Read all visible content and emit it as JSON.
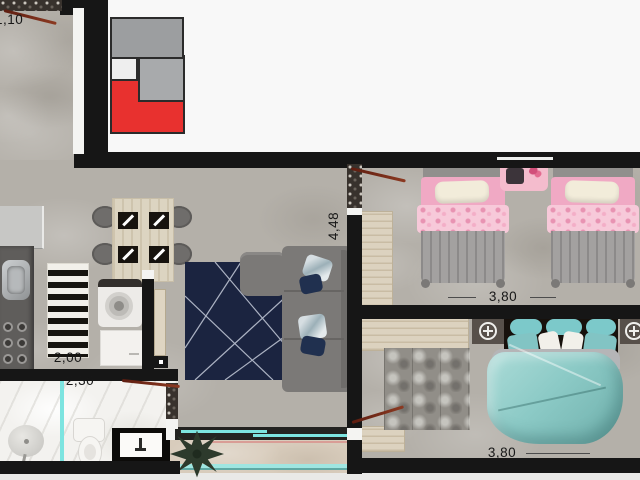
{
  "plan": {
    "type": "apartment-floor-plan-top-view",
    "dimensions": {
      "entry_width": "1,10",
      "kitchen_width": "2,00",
      "bathroom_width": "2,30",
      "living_depth": "4,48",
      "bedroom1_width": "3,80",
      "bedroom2_width": "3,80"
    },
    "rooms": [
      "entry-corridor",
      "kitchen",
      "living-dining",
      "bedroom-twin",
      "bedroom-double",
      "bathroom",
      "balcony"
    ],
    "colors": {
      "wall": "#161616",
      "floor_concrete": "#b4b0a9",
      "outside_white": "#f8f8f8",
      "keyplan_red": "#e8312f",
      "keyplan_gray": "#9c9ea0",
      "glass_teal": "#7de4e0",
      "rug_navy": "#1b2440",
      "bedding_pink": "#f0a9c4",
      "bedding_teal": "#8ccac6",
      "door_swing_brown": "#7b2817",
      "wood": "#dcd2bf"
    }
  }
}
